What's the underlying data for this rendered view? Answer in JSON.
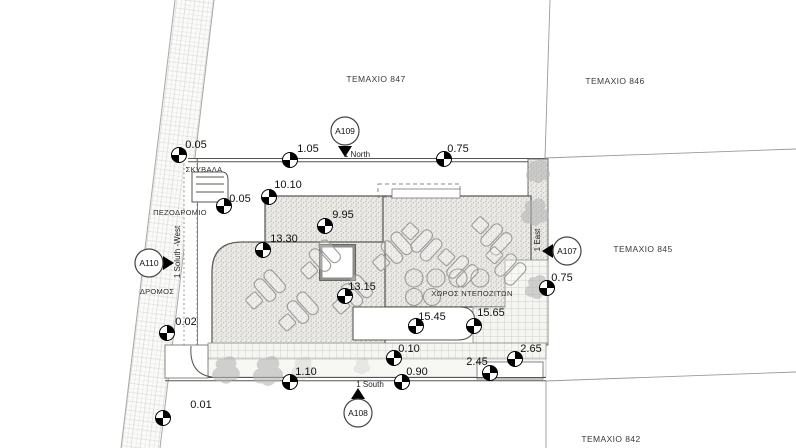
{
  "drawing": {
    "parcels": {
      "p847": "ΤΕΜΑΧΙΟ 847",
      "p846": "ΤΕΜΑΧΙΟ 846",
      "p845": "ΤΕΜΑΧΙΟ 845",
      "p842": "ΤΕΜΑΧΙΟ 842"
    },
    "labels": {
      "road": "ΔΡΟΜΟΣ",
      "sidewalk": "ΠΕΖΟΔΡΟΜΙΟ",
      "garbage": "ΣΚΥΒΑΛΑ",
      "deposits": "ΧΩΡΟΣ ΝΤΕΠΟΖΙΤΩΝ"
    },
    "edges": {
      "north": "1 North",
      "east": "1 East",
      "south": "1 South",
      "southwest": "1 Soluth -West"
    },
    "callouts": {
      "north": "A109",
      "south": "A108",
      "east": "A107",
      "west": "A110"
    },
    "dims": {
      "n_005": "0.05",
      "n_105": "1.05",
      "n_075": "0.75",
      "w_005": "0.05",
      "d1010": "10.10",
      "d995": "9.95",
      "d1330": "13.30",
      "d1315": "13.15",
      "e_075": "0.75",
      "d1545": "15.45",
      "d1565": "15.65",
      "d010": "0.10",
      "d110": "1.10",
      "d090": "0.90",
      "d245": "2.45",
      "d265": "2.65",
      "d002": "0.02",
      "d001": "0.01"
    },
    "colors": {
      "paper": "#ffffff",
      "ink": "#1a1a1a",
      "line": "#5c5c5c",
      "deck_fill": "#eceae7",
      "vegetation": "#b5b5b5"
    }
  }
}
